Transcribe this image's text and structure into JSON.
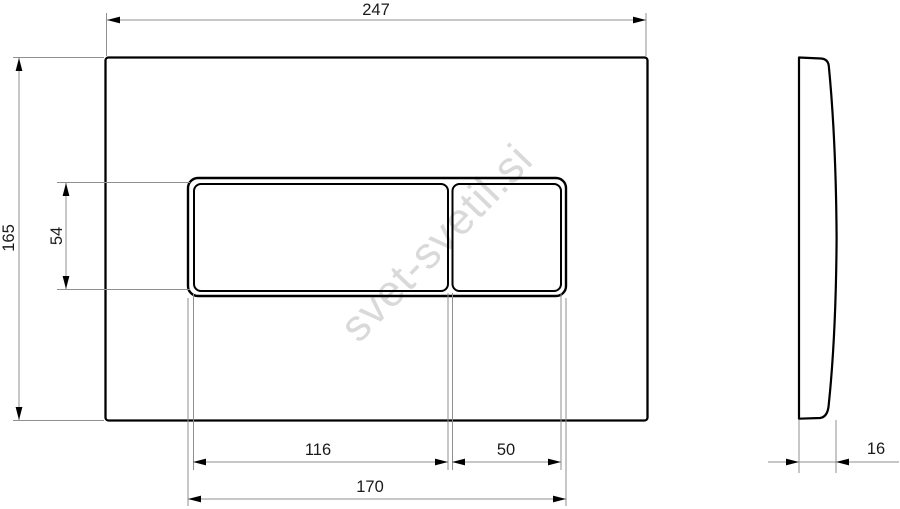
{
  "drawing": {
    "watermark": "svet-svetil.si",
    "dimensions": {
      "plate_width": "247",
      "plate_height": "165",
      "button_opening_height": "54",
      "large_button_width": "116",
      "small_button_width": "50",
      "button_opening_width": "170",
      "plate_thickness": "16"
    },
    "colors": {
      "outline": "#000000",
      "dimension_line": "#8f8f8f",
      "dimension_text": "#1a1a1a",
      "watermark": "#d9d9d9",
      "background": "#ffffff"
    }
  }
}
